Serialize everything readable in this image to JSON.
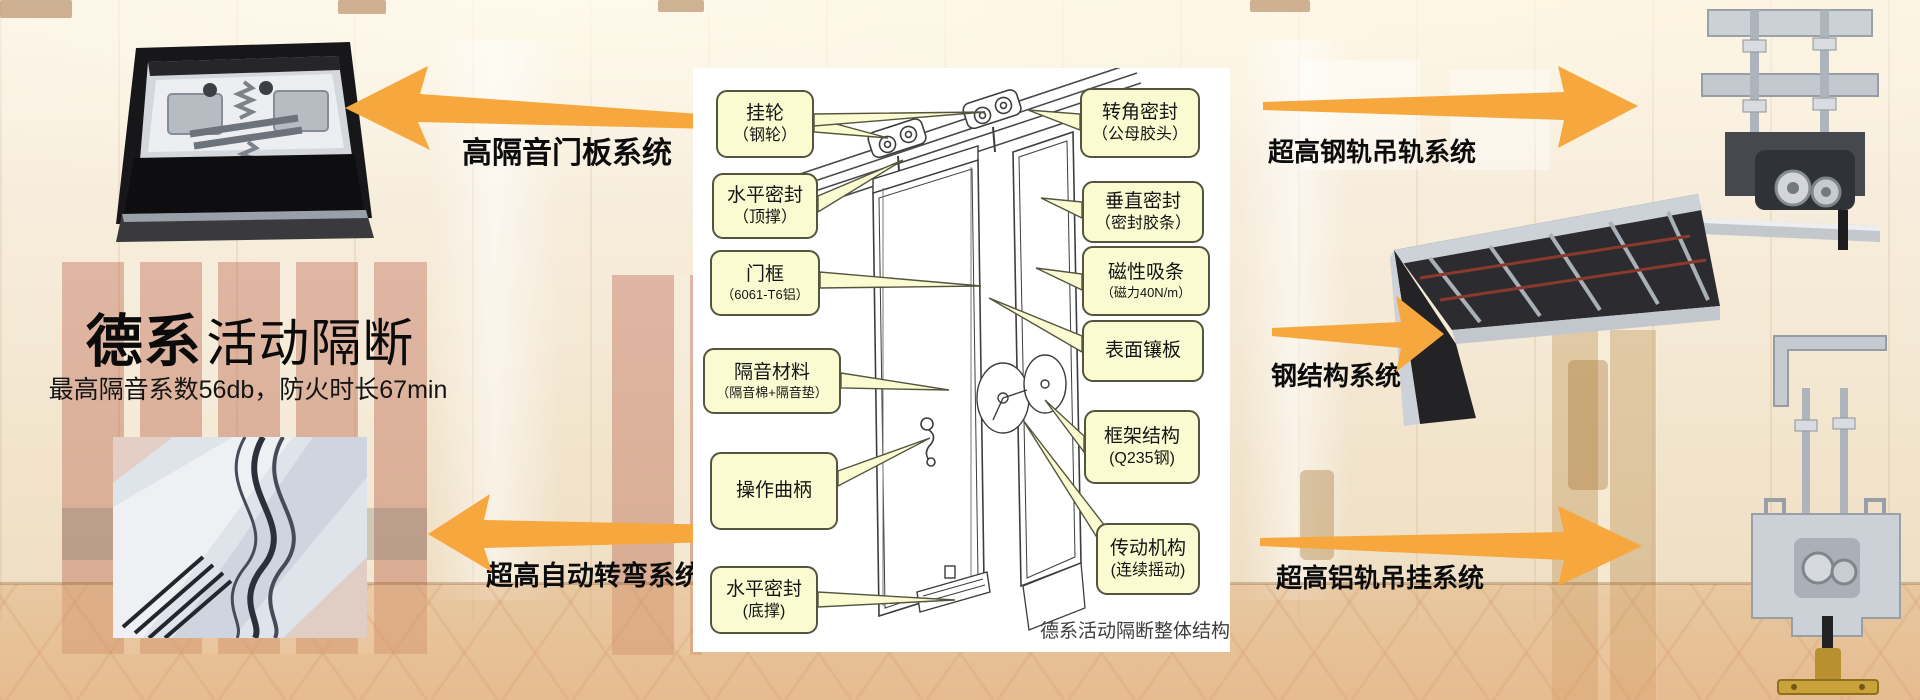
{
  "brand": {
    "title_bold": "德系",
    "title_rest": "活动隔断",
    "subtitle": "最高隔音系数56db，防火时长67min"
  },
  "system_labels": {
    "left_top": "高隔音门板系统",
    "left_bottom": "超高自动转弯系统",
    "right_top": "超高钢轨吊轨系统",
    "right_middle": "钢结构系统",
    "right_bottom": "超高铝轨吊挂系统"
  },
  "diagram": {
    "caption": "德系活动隔断整体结构",
    "left_callouts": [
      {
        "l1": "挂轮",
        "l2": "（钢轮）"
      },
      {
        "l1": "水平密封",
        "l2": "（顶撑）"
      },
      {
        "l1": "门框",
        "l2": "（6061-T6铝）"
      },
      {
        "l1": "隔音材料",
        "l2": "（隔音棉+隔音垫）"
      },
      {
        "l1": "操作曲柄",
        "l2": ""
      },
      {
        "l1": "水平密封",
        "l2": "(底撑)"
      }
    ],
    "right_callouts": [
      {
        "l1": "转角密封",
        "l2": "（公母胶头）"
      },
      {
        "l1": "垂直密封",
        "l2": "（密封胶条）"
      },
      {
        "l1": "磁性吸条",
        "l2": "（磁力40N/m）"
      },
      {
        "l1": "表面镶板",
        "l2": ""
      },
      {
        "l1": "框架结构",
        "l2": "(Q235钢)"
      },
      {
        "l1": "传动机构",
        "l2": "(连续摇动)"
      }
    ]
  },
  "icons": {
    "arrow_left_top": "tapered-arrow-pointing-left",
    "arrow_left_bottom": "tapered-arrow-pointing-left",
    "arrow_right_top": "tapered-arrow-pointing-right",
    "arrow_right_middle": "tapered-arrow-pointing-right",
    "arrow_right_bottom": "tapered-arrow-pointing-right"
  },
  "colors": {
    "arrow_orange": "#F6A73E",
    "callout_bg": "#FBFBD2",
    "callout_border": "#55553F",
    "text_black": "#111111",
    "panel_white": "#FFFFFF"
  }
}
